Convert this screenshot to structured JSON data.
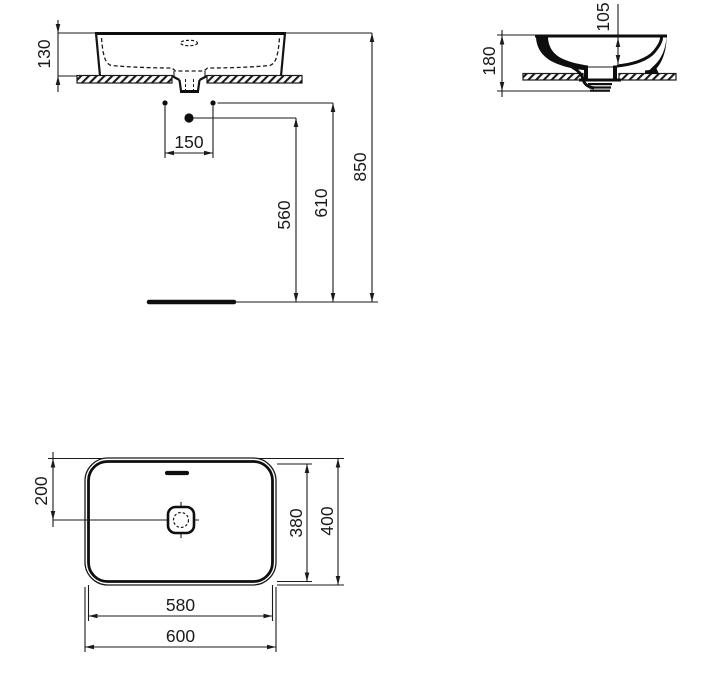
{
  "drawing_title": "Countertop washbasin technical drawing, dimensions in mm",
  "colors": {
    "background": "#ffffff",
    "line": "#1a1a1a"
  },
  "views": {
    "front": {
      "label": "front-elevation",
      "dims": {
        "basin_height_above_counter": "130",
        "hole_spacing": "150",
        "large_hole_to_floor": "560",
        "small_holes_to_floor": "610",
        "top_edge_to_floor": "850"
      }
    },
    "side": {
      "label": "side-section",
      "dims": {
        "overall_height": "180",
        "bowl_depth": "105"
      }
    },
    "plan": {
      "label": "plan-view",
      "dims": {
        "front_edge_to_drain_center": "200",
        "inner_width_depth": "380",
        "outer_width_depth": "400",
        "inner_length": "580",
        "outer_length": "600"
      }
    }
  }
}
